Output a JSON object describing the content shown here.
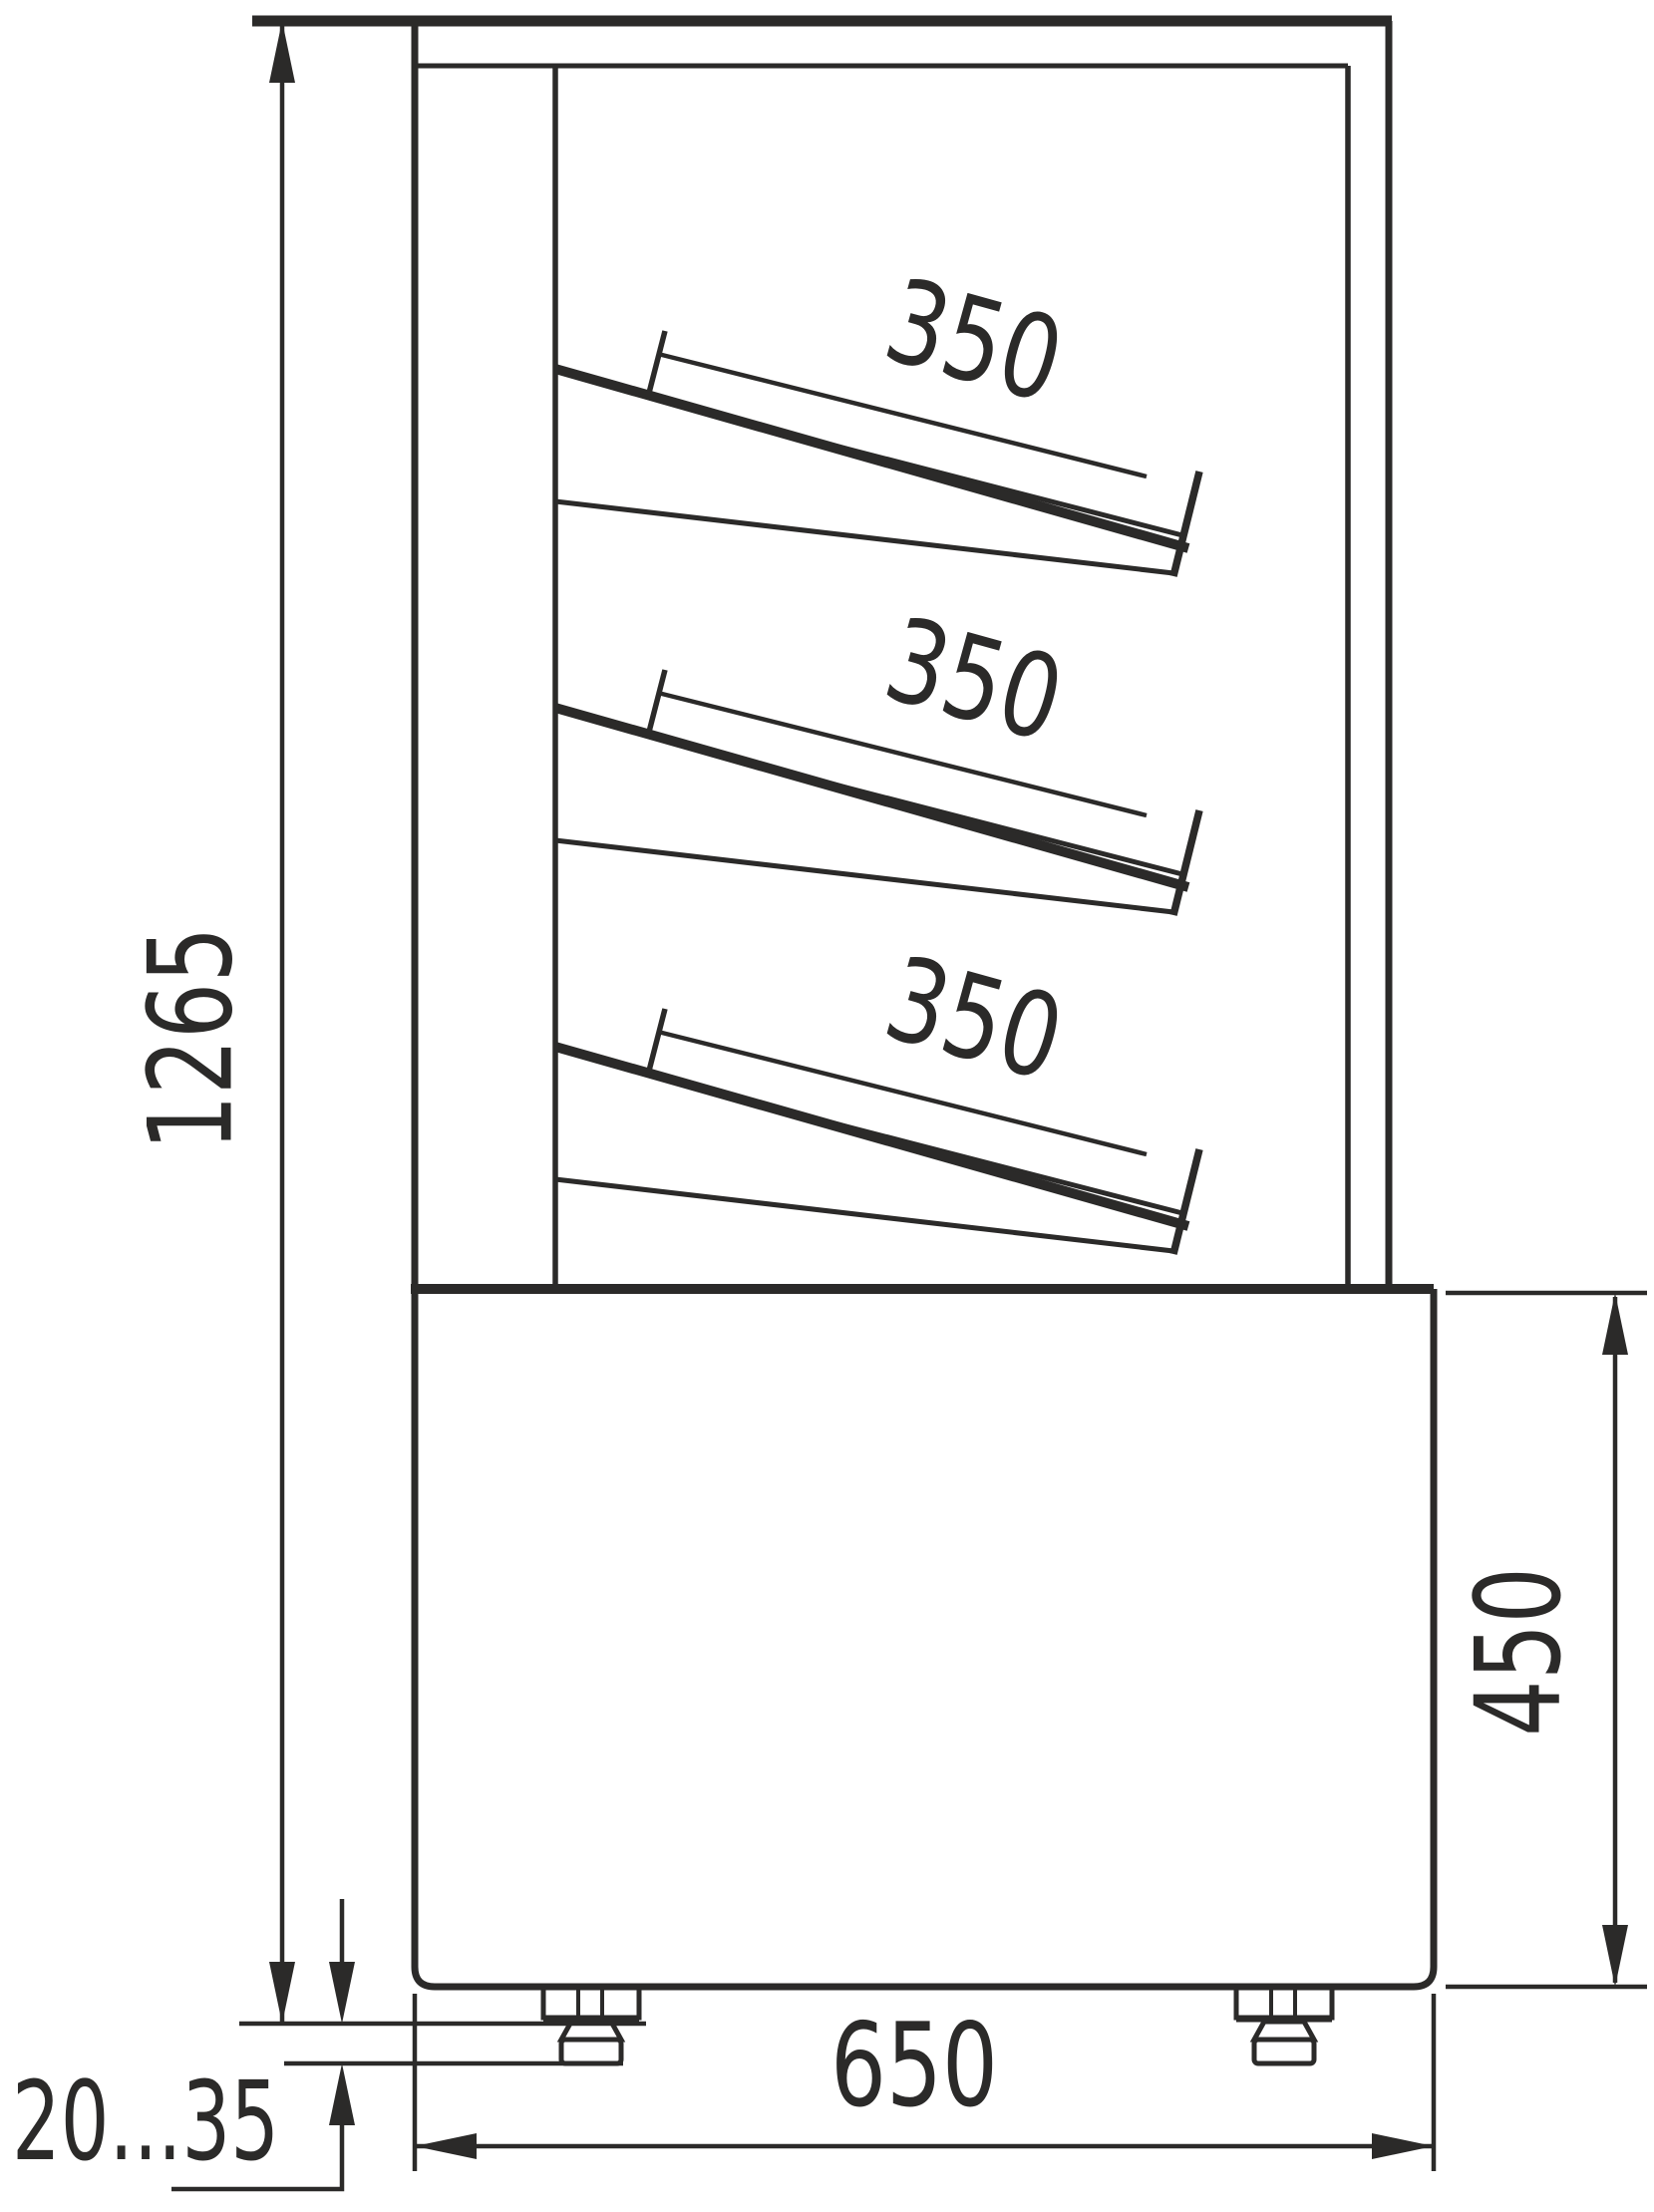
{
  "drawing": {
    "subject": "refrigerated-display-case-side-view",
    "background_color": "#ffffff",
    "line_color": "#2b2a29",
    "dimensions": {
      "overall_height": "1265",
      "shelf_depth_top": "350",
      "shelf_depth_middle": "350",
      "shelf_depth_bottom": "350",
      "base_height": "450",
      "base_width": "650",
      "feet_adjust_range": "20...35"
    }
  }
}
